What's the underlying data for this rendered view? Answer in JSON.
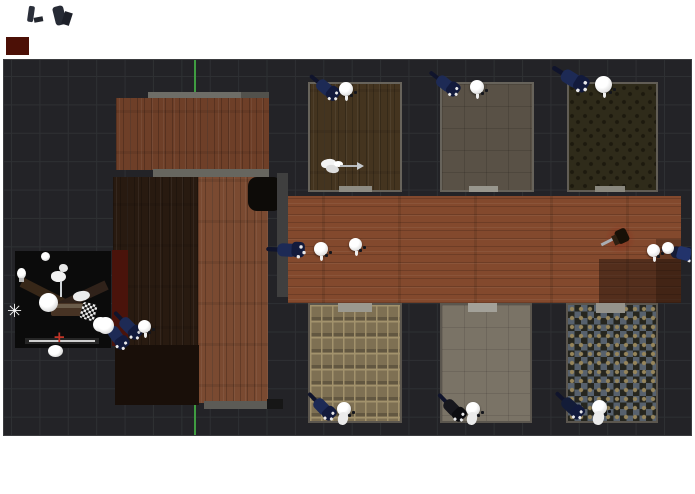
{
  "app": {
    "kind": "3d-level-editor-top-view",
    "background_white": "#ffffff",
    "viewport": {
      "x": 3,
      "y": 59,
      "w": 687,
      "h": 375,
      "bg": "#232327",
      "grid_color": "#2e3033",
      "grid_size": 28.4,
      "grid_offset_x": 7,
      "grid_offset_y": 16,
      "border": "#3b3c3f"
    }
  },
  "scene": {
    "structures": [
      {
        "name": "axis-y-green",
        "type": "rect",
        "x": 193,
        "y": 59,
        "w": 2,
        "h": 375,
        "c": "#3f9c41"
      },
      {
        "name": "wall-top-strip",
        "type": "rect",
        "x": 147,
        "y": 91,
        "w": 93,
        "h": 7,
        "c": "#6e6d67"
      },
      {
        "name": "wall-top-strip-dark",
        "type": "rect",
        "x": 240,
        "y": 91,
        "w": 28,
        "h": 7,
        "c": "#52514c"
      },
      {
        "name": "upper-room-floor",
        "type": "wood-v",
        "x": 115,
        "y": 97,
        "w": 153,
        "h": 72,
        "c": "#6e3f28"
      },
      {
        "name": "wall-mid-strip",
        "type": "rect",
        "x": 152,
        "y": 168,
        "w": 116,
        "h": 8,
        "c": "#67665f"
      },
      {
        "name": "dark-room-floor",
        "type": "wood-v",
        "x": 112,
        "y": 176,
        "w": 86,
        "h": 168,
        "c": "#281a10"
      },
      {
        "name": "tall-room-floor",
        "type": "wood-v",
        "x": 197,
        "y": 176,
        "w": 70,
        "h": 226,
        "c": "#7a4a31"
      },
      {
        "name": "bottom-dark-room",
        "type": "rect",
        "x": 114,
        "y": 344,
        "w": 84,
        "h": 60,
        "c": "#190f09"
      },
      {
        "name": "black-alcove",
        "type": "rect",
        "x": 247,
        "y": 176,
        "w": 34,
        "h": 34,
        "c": "#0d0b08",
        "r": 9
      },
      {
        "name": "maroon-wall",
        "type": "rect",
        "x": 111,
        "y": 249,
        "w": 16,
        "h": 96,
        "c": "#4a130b"
      },
      {
        "name": "corridor-left-wall",
        "type": "rect",
        "x": 276,
        "y": 172,
        "w": 11,
        "h": 124,
        "c": "#3f3f3f"
      },
      {
        "name": "corridor-floor",
        "type": "wood-h",
        "x": 287,
        "y": 195,
        "w": 393,
        "h": 107,
        "c": "#83492d"
      },
      {
        "name": "corridor-shadow-right",
        "type": "rect",
        "x": 598,
        "y": 258,
        "w": 82,
        "h": 44,
        "c": "rgba(25,14,8,0.45)"
      },
      {
        "name": "corridor-shadow-right-upper",
        "type": "rect",
        "x": 655,
        "y": 238,
        "w": 25,
        "h": 64,
        "c": "rgba(25,14,8,0.30)"
      },
      {
        "name": "wall-bottom-strip",
        "type": "rect",
        "x": 203,
        "y": 400,
        "w": 63,
        "h": 8,
        "c": "#5c5b56"
      },
      {
        "name": "wall-bottom-dark",
        "type": "rect",
        "x": 266,
        "y": 398,
        "w": 16,
        "h": 10,
        "c": "#161616"
      }
    ],
    "rooms": [
      {
        "name": "room-top-1",
        "x": 307,
        "y": 81,
        "w": 94,
        "h": 110,
        "wall": "#67635b",
        "floor": {
          "type": "wood-v",
          "c": "#44341f"
        },
        "door": {
          "x": 31,
          "y": 104,
          "w": 33,
          "h": 6,
          "c": "#8e8c83"
        }
      },
      {
        "name": "room-top-2",
        "x": 439,
        "y": 81,
        "w": 94,
        "h": 110,
        "wall": "#67635b",
        "floor": {
          "type": "faint-grid",
          "c": "#595146",
          "c2": "rgba(0,0,0,0.12)"
        },
        "door": {
          "x": 29,
          "y": 104,
          "w": 29,
          "h": 6,
          "c": "#98968d"
        }
      },
      {
        "name": "room-top-3",
        "x": 566,
        "y": 81,
        "w": 91,
        "h": 110,
        "wall": "#615d55",
        "floor": {
          "type": "speckle",
          "c": "#2f2b1a",
          "c2": "#1d1a0e"
        },
        "door": {
          "x": 28,
          "y": 104,
          "w": 30,
          "h": 6,
          "c": "#8a887e"
        }
      },
      {
        "name": "room-bottom-1",
        "x": 307,
        "y": 302,
        "w": 94,
        "h": 120,
        "wall": "#5b564e",
        "floor": {
          "type": "tiles",
          "c": "#7e7053",
          "c2": "#a2926c"
        },
        "door": {
          "x": 30,
          "y": 0,
          "w": 34,
          "h": 9,
          "c": "#9b998f"
        }
      },
      {
        "name": "room-bottom-2",
        "x": 439,
        "y": 302,
        "w": 92,
        "h": 120,
        "wall": "#5b564e",
        "floor": {
          "type": "faint-grid",
          "c": "#7a7366",
          "c2": "rgba(0,0,0,0.10)"
        },
        "door": {
          "x": 28,
          "y": 0,
          "w": 29,
          "h": 9,
          "c": "#a3a199"
        }
      },
      {
        "name": "room-bottom-3",
        "x": 565,
        "y": 302,
        "w": 92,
        "h": 120,
        "wall": "#5b564e",
        "floor": {
          "type": "checker",
          "c": "#57616d",
          "c2": "#26261f",
          "c3": "#96855b"
        },
        "door": {
          "x": 30,
          "y": 0,
          "w": 29,
          "h": 10,
          "c": "#95938b"
        }
      }
    ],
    "preview_room": {
      "name": "render-preview-room",
      "x": 14,
      "y": 250,
      "w": 96,
      "h": 97,
      "c": "#0b0b0b",
      "children": [
        {
          "name": "preview-wall-left",
          "type": "rect",
          "x": 4,
          "y": 38,
          "w": 52,
          "h": 10,
          "c": "#372718",
          "rot": 27
        },
        {
          "name": "preview-wall-right",
          "type": "rect",
          "x": 42,
          "y": 40,
          "w": 52,
          "h": 10,
          "c": "#30221a",
          "rot": -25
        },
        {
          "name": "preview-table",
          "type": "rect",
          "x": 36,
          "y": 52,
          "w": 34,
          "h": 13,
          "c": "#473324",
          "r": 2
        },
        {
          "name": "preview-table-top",
          "type": "rect",
          "x": 38,
          "y": 53,
          "w": 30,
          "h": 4,
          "c": "#6b5c4a"
        },
        {
          "name": "preview-sphere-large",
          "type": "sphere",
          "x": 24,
          "y": 42,
          "w": 19,
          "h": 19
        },
        {
          "name": "preview-sphere-top",
          "type": "sphere",
          "x": 26,
          "y": 1,
          "w": 9,
          "h": 9
        },
        {
          "name": "preview-lamp-blob",
          "type": "blob",
          "x": 36,
          "y": 20,
          "w": 15,
          "h": 11,
          "c": "#f2f2f2"
        },
        {
          "name": "preview-lamp-blob-2",
          "type": "blob",
          "x": 44,
          "y": 13,
          "w": 9,
          "h": 8,
          "c": "#e8e8e8"
        },
        {
          "name": "preview-lamp-stem",
          "type": "rect",
          "x": 45,
          "y": 30,
          "w": 2,
          "h": 16,
          "c": "#cfd4d8"
        },
        {
          "name": "preview-bulb-left",
          "type": "sphere",
          "x": 2,
          "y": 17,
          "w": 9,
          "h": 11
        },
        {
          "name": "preview-bulb-base",
          "type": "rect",
          "x": 4,
          "y": 27,
          "w": 5,
          "h": 4,
          "c": "#b8b8b8"
        },
        {
          "name": "preview-star-sparkle",
          "type": "glyph",
          "x": -8,
          "y": 52,
          "glyph": "✳",
          "c": "#f4f4f4",
          "fs": 18
        },
        {
          "name": "preview-paper-shape",
          "type": "blob",
          "x": 58,
          "y": 40,
          "w": 17,
          "h": 10,
          "c": "#ececec",
          "rot": -12
        },
        {
          "name": "preview-checker-figure",
          "type": "checker-mini",
          "x": 66,
          "y": 52,
          "w": 15,
          "h": 17,
          "rot": 15
        },
        {
          "name": "preview-bottom-bar",
          "type": "rect",
          "x": 10,
          "y": 87,
          "w": 74,
          "h": 6,
          "c": "#262626"
        },
        {
          "name": "preview-bottom-line",
          "type": "rect",
          "x": 14,
          "y": 89,
          "w": 66,
          "h": 1.5,
          "c": "#cfcfcf"
        },
        {
          "name": "preview-red-cross",
          "type": "glyph",
          "x": 38,
          "y": 79,
          "glyph": "+",
          "c": "#c23527",
          "fs": 15
        },
        {
          "name": "preview-sphere-bottom",
          "type": "sphere",
          "x": 33,
          "y": 94,
          "w": 15,
          "h": 12
        },
        {
          "name": "preview-corner-sphere",
          "type": "sphere",
          "x": 78,
          "y": 66,
          "w": 15,
          "h": 15
        },
        {
          "name": "preview-corner-knight",
          "type": "knight",
          "x": 82,
          "y": 74,
          "rot": 55,
          "c": "#1d2a55",
          "c2": "#10142c",
          "c3": "#131b3e"
        }
      ]
    },
    "characters": [
      {
        "name": "knight-top-1",
        "type": "knight",
        "x": 305,
        "y": 77,
        "rot": 40
      },
      {
        "name": "knight-top-2",
        "type": "knight",
        "x": 425,
        "y": 73,
        "rot": 38
      },
      {
        "name": "knight-top-3",
        "type": "knight",
        "x": 551,
        "y": 68,
        "rot": 32,
        "scale": 1.15
      },
      {
        "name": "knight-corridor-left",
        "type": "knight",
        "x": 267,
        "y": 240,
        "rot": 3,
        "scale": 1.1
      },
      {
        "name": "knight-corridor-right",
        "type": "knight",
        "x": 660,
        "y": 243,
        "rot": 12,
        "c": "#151b36"
      },
      {
        "name": "knight-right-tail",
        "type": "rect",
        "x": 676,
        "y": 246,
        "w": 14,
        "h": 13,
        "c": "#22336b",
        "rot": 14,
        "r": 3
      },
      {
        "name": "knight-bottom-1",
        "type": "knight",
        "x": 302,
        "y": 396,
        "rot": 46
      },
      {
        "name": "knight-bottom-2",
        "type": "knight",
        "x": 432,
        "y": 397,
        "rot": 46,
        "c": "#17171d",
        "c3": "#0c0c10"
      },
      {
        "name": "knight-bottom-3",
        "type": "knight",
        "x": 550,
        "y": 395,
        "rot": 44,
        "c": "#131c38"
      },
      {
        "name": "knight-left-building",
        "type": "knight",
        "x": 108,
        "y": 315,
        "rot": 46
      }
    ],
    "heads": [
      {
        "name": "head-top-1",
        "x": 338,
        "y": 81,
        "d": 14,
        "sp": true
      },
      {
        "name": "head-top-2",
        "x": 469,
        "y": 79,
        "d": 14,
        "sp": true
      },
      {
        "name": "head-top-3",
        "x": 594,
        "y": 75,
        "d": 17,
        "sp": true
      },
      {
        "name": "head-corridor-1",
        "x": 313,
        "y": 241,
        "d": 14,
        "sp": true
      },
      {
        "name": "head-corridor-2",
        "x": 348,
        "y": 237,
        "d": 13,
        "sp": true
      },
      {
        "name": "head-corridor-right",
        "x": 646,
        "y": 243,
        "d": 13,
        "sp": true
      },
      {
        "name": "sphere-corridor-right",
        "x": 661,
        "y": 241,
        "d": 12,
        "plain": true
      },
      {
        "name": "head-bottom-1",
        "x": 336,
        "y": 401,
        "d": 14,
        "sp": true,
        "body": true
      },
      {
        "name": "head-bottom-2",
        "x": 465,
        "y": 401,
        "d": 14,
        "sp": true,
        "body": true
      },
      {
        "name": "head-bottom-3",
        "x": 591,
        "y": 399,
        "d": 15,
        "sp": true,
        "body": true
      },
      {
        "name": "head-left-building",
        "x": 137,
        "y": 319,
        "d": 13,
        "sp": true
      },
      {
        "name": "sphere-left-building",
        "x": 96,
        "y": 316,
        "d": 17,
        "plain": true
      }
    ],
    "props": [
      {
        "name": "arrow-blob-1",
        "type": "blob",
        "x": 320,
        "y": 158,
        "w": 15,
        "h": 9,
        "c": "#f3f3f3",
        "rot": -12
      },
      {
        "name": "arrow-blob-2",
        "type": "blob",
        "x": 325,
        "y": 164,
        "w": 13,
        "h": 8,
        "c": "#dddddd",
        "rot": 8
      },
      {
        "name": "arrow-blob-3",
        "type": "blob",
        "x": 333,
        "y": 160,
        "w": 9,
        "h": 6,
        "c": "#ffffff"
      },
      {
        "name": "arrow-shaft",
        "type": "rect",
        "x": 339,
        "y": 164,
        "w": 19,
        "h": 2,
        "c": "#b6babe"
      },
      {
        "name": "arrow-head",
        "type": "tri",
        "x": 356,
        "y": 161,
        "c": "#c6cace"
      },
      {
        "name": "sword-glow",
        "type": "glow",
        "x": 603,
        "y": 223,
        "w": 32,
        "h": 30,
        "c": "rgba(145,40,22,0.55)"
      },
      {
        "name": "sword-blade",
        "type": "rect",
        "x": 599,
        "y": 237,
        "w": 24,
        "h": 3,
        "c": "#a9adb2",
        "rot": -27
      },
      {
        "name": "sword-hilt",
        "type": "rect",
        "x": 615,
        "y": 228,
        "w": 12,
        "h": 14,
        "c": "#171007",
        "rot": -25,
        "r": 3
      },
      {
        "name": "sword-guard",
        "type": "rect",
        "x": 612,
        "y": 234,
        "w": 5,
        "h": 10,
        "c": "#2e2012",
        "rot": -25
      }
    ],
    "artifacts": [
      {
        "name": "stray-mark-1",
        "type": "rect",
        "x": 28,
        "y": 6,
        "w": 6,
        "h": 16,
        "c": "#2b2f3a",
        "rot": 8,
        "r": 2
      },
      {
        "name": "stray-mark-2",
        "type": "rect",
        "x": 34,
        "y": 17,
        "w": 9,
        "h": 5,
        "c": "#23262e",
        "rot": -10
      },
      {
        "name": "stray-mark-3",
        "type": "rect",
        "x": 54,
        "y": 6,
        "w": 11,
        "h": 19,
        "c": "#272b35",
        "rot": -14,
        "r": 3
      },
      {
        "name": "stray-mark-4",
        "type": "rect",
        "x": 63,
        "y": 12,
        "w": 8,
        "h": 13,
        "c": "#1d2029",
        "rot": 18
      },
      {
        "name": "stray-red-block",
        "type": "rect",
        "x": 6,
        "y": 37,
        "w": 23,
        "h": 18,
        "c": "#4c1006"
      }
    ]
  }
}
